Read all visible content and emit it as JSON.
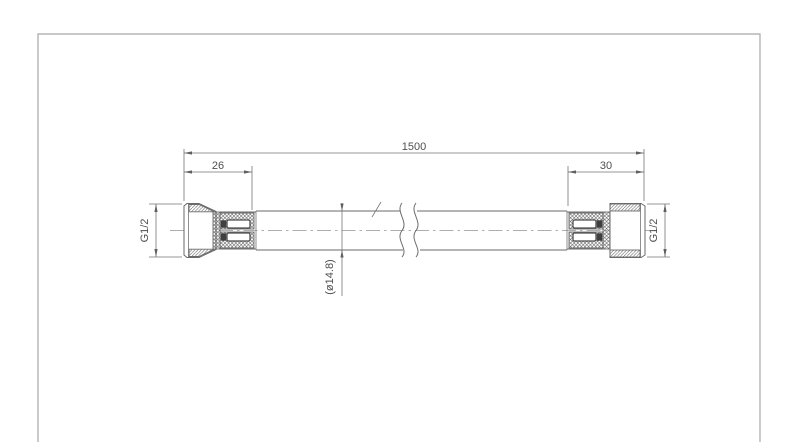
{
  "page": {
    "background": "#ffffff"
  },
  "drawing": {
    "kind": "technical-drawing",
    "subject": "flexible-hose-with-end-fittings",
    "dimensions": {
      "overall_length": "1500",
      "left_fitting_length": "26",
      "right_fitting_length": "30",
      "left_thread": "G1/2",
      "right_thread": "G1/2",
      "hose_outer_diameter": "(ø14.8)"
    },
    "colors": {
      "line": "#6a6a6a",
      "dimension_line": "#757575",
      "text": "#4f4f4f",
      "border": "#a8a8a8",
      "centerline": "#949494",
      "hatch": "#555555",
      "background": "#ffffff"
    }
  }
}
